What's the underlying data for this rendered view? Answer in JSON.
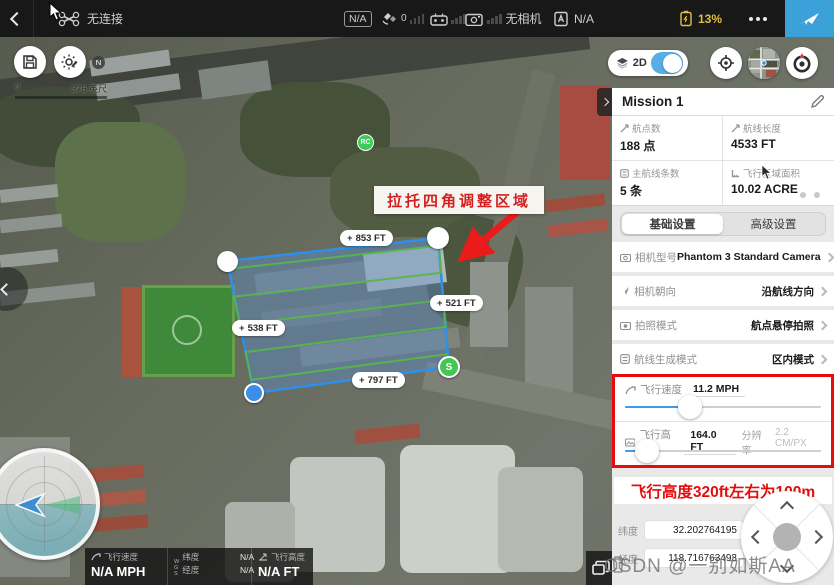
{
  "top_bar": {
    "connection_status": "无连接",
    "gps_badge": "N/A",
    "satellite_count": "0",
    "camera_status": "无相机",
    "flight_mode_value": "N/A",
    "battery_percent": "13%"
  },
  "map": {
    "scale_zero": "0",
    "scale_label": "375 英尺",
    "rc_marker": "RC",
    "annotation": "拉托四角调整区域",
    "plus": "+",
    "edge_labels": {
      "top": "853 FT",
      "right": "521 FT",
      "left": "538 FT",
      "bottom": "797 FT"
    },
    "start_marker": "S",
    "north": "N",
    "view_toggle_label": "2D"
  },
  "panel": {
    "title": "Mission 1",
    "stats": [
      {
        "label": "航点数",
        "value": "188 点"
      },
      {
        "label": "航线长度",
        "value": "4533 FT"
      },
      {
        "label": "主航线条数",
        "value": "5 条"
      },
      {
        "label": "飞行区域面积",
        "value": "10.02 ACRE"
      }
    ],
    "tabs": [
      {
        "label": "基础设置"
      },
      {
        "label": "高级设置"
      }
    ],
    "settings": [
      {
        "label": "相机型号",
        "value": "Phantom 3 Standard Camera"
      },
      {
        "label": "相机朝向",
        "value": "沿航线方向"
      },
      {
        "label": "拍照模式",
        "value": "航点悬停拍照"
      },
      {
        "label": "航线生成模式",
        "value": "区内模式"
      }
    ],
    "speed": {
      "label": "飞行速度",
      "value": "11.2 MPH",
      "percent": 31
    },
    "altitude": {
      "label": "飞行高度",
      "value": "164.0 FT",
      "res_label": "分辨率",
      "res_value": "2.2 CM/PX",
      "percent": 11
    },
    "note": "飞行高度320ft左右为100m",
    "coords": [
      {
        "label": "纬度",
        "value": "32.202764195"
      },
      {
        "label": "经度",
        "value": "118.716763493"
      }
    ]
  },
  "telemetry": {
    "speed_label": "飞行速度",
    "speed_value": "N/A MPH",
    "wgs": "WGS",
    "lat_label": "纬度",
    "lat_value": "N/A",
    "lng_label": "经度",
    "lng_value": "N/A",
    "alt_label": "飞行高度",
    "alt_value": "N/A FT"
  },
  "watermark": "CSDN @一别如斯AA",
  "colors": {
    "accent_blue": "#3ba2d9",
    "polygon_stroke": "#2f8fe8",
    "path_green": "#56b54e",
    "alert_red": "#e60c0c",
    "battery_yellow": "#e3bd43"
  }
}
